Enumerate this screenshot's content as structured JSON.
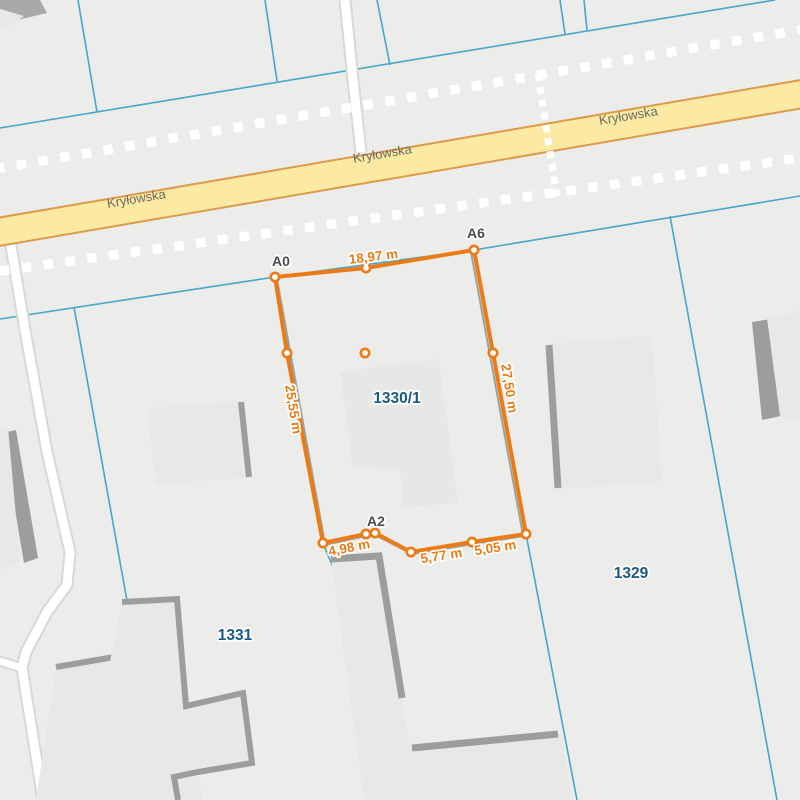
{
  "map": {
    "street_name": "Kryłowska",
    "parcel_ids": [
      "1330/1",
      "1329",
      "1331"
    ],
    "measurement_summary": {
      "vertex_names": [
        "A0",
        "A6",
        "A2"
      ],
      "segment_lengths": [
        "18,97 m",
        "27,50 m",
        "25,55 m",
        "4,98 m",
        "5,77 m",
        "5,05 m"
      ]
    },
    "colors": {
      "bg": "#ececea",
      "boundary_blue": "#46a6cb",
      "road_fill": "#fce9a2",
      "road_border": "#dd9a4b",
      "white_road": "#ffffff",
      "white_road_casing": "#d8d8d6",
      "dashed_white": "#ffffff",
      "building_fill": "#e8e8e6",
      "building_edge": "#9d9d9b",
      "building_dark": "#a9a9a7",
      "underlay_gray": "#9aa49e",
      "measure_orange": "#ec7b16",
      "measure_text": "#e87c14",
      "vertex_text": "#4b4b4b",
      "parcel_text": "#1b5a80",
      "street_text": "#6b6b66"
    },
    "layers": [
      {
        "kind": "polyline",
        "name": "parcel-boundary-upper-long",
        "stroke": "#46a6cb",
        "sw": 1.6,
        "points": [
          [
            0,
            128
          ],
          [
            775,
            0
          ]
        ]
      },
      {
        "kind": "polyline",
        "name": "parcel-boundary-top-1",
        "stroke": "#46a6cb",
        "sw": 1.6,
        "points": [
          [
            78,
            0
          ],
          [
            97,
            112
          ]
        ]
      },
      {
        "kind": "polyline",
        "name": "parcel-boundary-top-2",
        "stroke": "#46a6cb",
        "sw": 1.6,
        "points": [
          [
            265,
            0
          ],
          [
            277,
            81
          ]
        ]
      },
      {
        "kind": "polyline",
        "name": "parcel-boundary-top-3",
        "stroke": "#46a6cb",
        "sw": 1.6,
        "points": [
          [
            377,
            0
          ],
          [
            390,
            65
          ]
        ]
      },
      {
        "kind": "polyline",
        "name": "parcel-boundary-top-4",
        "stroke": "#46a6cb",
        "sw": 1.6,
        "points": [
          [
            560,
            0
          ],
          [
            565,
            34
          ]
        ]
      },
      {
        "kind": "polyline",
        "name": "parcel-boundary-top-5",
        "stroke": "#46a6cb",
        "sw": 1.6,
        "points": [
          [
            584,
            0
          ],
          [
            587,
            30
          ]
        ]
      },
      {
        "kind": "polyline",
        "name": "parcel-boundary-lower-long",
        "stroke": "#46a6cb",
        "sw": 1.6,
        "points": [
          [
            0,
            319
          ],
          [
            275,
            277
          ],
          [
            474,
            250
          ],
          [
            800,
            196
          ]
        ]
      },
      {
        "kind": "polyline",
        "name": "parcel-1331-left-boundary",
        "stroke": "#46a6cb",
        "sw": 1.6,
        "points": [
          [
            74,
            307
          ],
          [
            163,
            800
          ]
        ]
      },
      {
        "kind": "polyline",
        "name": "parcel-1330-left-boundary",
        "stroke": "#46a6cb",
        "sw": 1.6,
        "points": [
          [
            275,
            277
          ],
          [
            323,
            543
          ],
          [
            337,
            577
          ],
          [
            367,
            800
          ]
        ]
      },
      {
        "kind": "polyline",
        "name": "parcel-1330-right-boundary",
        "stroke": "#46a6cb",
        "sw": 1.6,
        "points": [
          [
            474,
            250
          ],
          [
            526,
            534
          ],
          [
            577,
            800
          ]
        ]
      },
      {
        "kind": "polyline",
        "name": "parcel-1329-right-boundary",
        "stroke": "#46a6cb",
        "sw": 1.6,
        "points": [
          [
            670,
            216
          ],
          [
            777,
            800
          ]
        ]
      },
      {
        "kind": "path",
        "name": "white-road-north-casing",
        "stroke": "#d8d8d6",
        "sw": 13,
        "d": "M345,0 L353,80 L361,152"
      },
      {
        "kind": "path",
        "name": "white-road-west-casing",
        "stroke": "#d8d8d6",
        "sw": 13,
        "d": "M10,240 L25,330 L47,452 L70,552 L67,585 L47,612 L26,652 L22,668 L43,800"
      },
      {
        "kind": "path",
        "name": "white-road-west-branch-casing",
        "stroke": "#d8d8d6",
        "sw": 11,
        "d": "M22,668 L-4,660"
      },
      {
        "kind": "path",
        "name": "white-road-north",
        "stroke": "#ffffff",
        "sw": 9,
        "d": "M345,0 L353,80 L361,152"
      },
      {
        "kind": "path",
        "name": "white-road-west",
        "stroke": "#ffffff",
        "sw": 9,
        "d": "M10,240 L25,330 L47,452 L70,552 L67,585 L47,612 L26,652 L22,668 L43,800"
      },
      {
        "kind": "path",
        "name": "white-road-west-branch",
        "stroke": "#ffffff",
        "sw": 7,
        "d": "M22,668 L-4,660"
      },
      {
        "kind": "polyline",
        "name": "road-krylowska-border",
        "stroke": "#dd9a4b",
        "sw": 30,
        "points": [
          [
            -8,
            233
          ],
          [
            808,
            93
          ]
        ]
      },
      {
        "kind": "polyline",
        "name": "road-krylowska-fill",
        "stroke": "#fce9a2",
        "sw": 26,
        "points": [
          [
            -8,
            233
          ],
          [
            808,
            93
          ]
        ]
      },
      {
        "kind": "polygon",
        "name": "building-topleft-dark",
        "fill": "#a9a9a7",
        "points": [
          [
            0,
            0
          ],
          [
            40,
            0
          ],
          [
            47,
            13
          ],
          [
            9,
            22
          ],
          [
            0,
            20
          ]
        ]
      },
      {
        "kind": "polygon",
        "name": "building-topleft-light",
        "fill": "#e8e8e6",
        "points": [
          [
            0,
            9
          ],
          [
            24,
            16
          ],
          [
            9,
            27
          ],
          [
            0,
            25
          ]
        ]
      },
      {
        "kind": "polygon",
        "name": "building-west-strip",
        "fill": "#9d9d9b",
        "points": [
          [
            2,
            433
          ],
          [
            16,
            430
          ],
          [
            38,
            558
          ],
          [
            24,
            563
          ]
        ]
      },
      {
        "kind": "polygon",
        "name": "building-west-strip-left",
        "fill": "#e8e8e6",
        "points": [
          [
            0,
            428
          ],
          [
            8,
            427
          ],
          [
            20,
            562
          ],
          [
            0,
            570
          ]
        ]
      },
      {
        "kind": "polygon",
        "name": "building-centerleft",
        "fill": "#e8e8e6",
        "points": [
          [
            147,
            408
          ],
          [
            240,
            401
          ],
          [
            250,
            477
          ],
          [
            156,
            484
          ]
        ]
      },
      {
        "kind": "polyline",
        "name": "building-centerleft-edge",
        "stroke": "#9d9d9b",
        "sw": 6,
        "points": [
          [
            241,
            402
          ],
          [
            249,
            477
          ]
        ]
      },
      {
        "kind": "polygon",
        "name": "building-parcel-1330",
        "fill": "#e7e7e5",
        "points": [
          [
            340,
            372
          ],
          [
            439,
            359
          ],
          [
            458,
            503
          ],
          [
            403,
            507
          ],
          [
            400,
            470
          ],
          [
            352,
            466
          ]
        ]
      },
      {
        "kind": "polygon",
        "name": "building-right-center",
        "fill": "#e8e8e6",
        "points": [
          [
            548,
            344
          ],
          [
            652,
            336
          ],
          [
            662,
            481
          ],
          [
            558,
            489
          ]
        ]
      },
      {
        "kind": "polyline",
        "name": "building-right-center-edge",
        "stroke": "#9d9d9b",
        "sw": 7,
        "points": [
          [
            549,
            345
          ],
          [
            558,
            488
          ]
        ]
      },
      {
        "kind": "polygon",
        "name": "building-east-dark",
        "fill": "#9d9d9b",
        "points": [
          [
            752,
            322
          ],
          [
            771,
            319
          ],
          [
            781,
            416
          ],
          [
            762,
            420
          ]
        ]
      },
      {
        "kind": "polygon",
        "name": "building-east-light",
        "fill": "#e8e8e6",
        "points": [
          [
            767,
            318
          ],
          [
            800,
            311
          ],
          [
            800,
            420
          ],
          [
            780,
            416
          ]
        ]
      },
      {
        "kind": "polygon",
        "name": "building-below-a2",
        "fill": "#e8e8e6",
        "points": [
          [
            331,
            559
          ],
          [
            379,
            556
          ],
          [
            402,
            700
          ],
          [
            410,
            745
          ],
          [
            560,
            733
          ],
          [
            572,
            800
          ],
          [
            364,
            800
          ]
        ]
      },
      {
        "kind": "polyline",
        "name": "building-below-a2-edge",
        "stroke": "#9d9d9b",
        "sw": 7,
        "points": [
          [
            331,
            559
          ],
          [
            379,
            556
          ],
          [
            402,
            698
          ]
        ]
      },
      {
        "kind": "polyline",
        "name": "building-below-a2-edge2",
        "stroke": "#9d9d9b",
        "sw": 7,
        "points": [
          [
            412,
            748
          ],
          [
            558,
            734
          ]
        ]
      },
      {
        "kind": "polygon",
        "name": "building-1331-south",
        "fill": "#e8e8e6",
        "points": [
          [
            56,
            667
          ],
          [
            132,
            654
          ],
          [
            142,
            742
          ],
          [
            96,
            800
          ],
          [
            36,
            800
          ]
        ]
      },
      {
        "kind": "polyline",
        "name": "building-1331-south-edge",
        "stroke": "#9d9d9b",
        "sw": 6,
        "points": [
          [
            56,
            667
          ],
          [
            132,
            654
          ]
        ]
      },
      {
        "kind": "polygon",
        "name": "building-1331-main",
        "fill": "#e8e8e6",
        "points": [
          [
            122,
            602
          ],
          [
            177,
            599
          ],
          [
            186,
            706
          ],
          [
            243,
            693
          ],
          [
            252,
            763
          ],
          [
            198,
            772
          ],
          [
            203,
            800
          ],
          [
            82,
            800
          ]
        ]
      },
      {
        "kind": "polyline",
        "name": "building-1331-main-edge",
        "stroke": "#9d9d9b",
        "sw": 6,
        "points": [
          [
            122,
            602
          ],
          [
            177,
            599
          ],
          [
            186,
            706
          ],
          [
            243,
            693
          ],
          [
            252,
            763
          ],
          [
            198,
            772
          ],
          [
            174,
            777
          ],
          [
            178,
            800
          ]
        ]
      },
      {
        "kind": "polyline",
        "name": "dashed-line-above-road",
        "stroke": "#ffffff",
        "sw": 9.5,
        "dash": "9.5 12.5",
        "points": [
          [
            -5,
            169
          ],
          [
            805,
            29
          ]
        ]
      },
      {
        "kind": "polyline",
        "name": "dashed-line-below-road",
        "stroke": "#ffffff",
        "sw": 9.5,
        "dash": "9.5 12.5",
        "points": [
          [
            0,
            271
          ],
          [
            800,
            158
          ]
        ]
      },
      {
        "kind": "polyline",
        "name": "dashed-line-crossing",
        "stroke": "#ffffff",
        "sw": 7,
        "dash": "7 6",
        "points": [
          [
            538,
            74
          ],
          [
            557,
            198
          ]
        ]
      },
      {
        "kind": "polyline",
        "name": "measure-underlay-right",
        "stroke": "#9aa49e",
        "sw": 2,
        "points": [
          [
            471,
            252
          ],
          [
            523,
            535
          ]
        ]
      },
      {
        "kind": "polyline",
        "name": "measure-underlay-left",
        "stroke": "#9aa49e",
        "sw": 2,
        "points": [
          [
            277,
            279
          ],
          [
            325,
            544
          ]
        ]
      },
      {
        "kind": "polyline",
        "name": "measure-underlay-bottom",
        "stroke": "#9aa49e",
        "sw": 2,
        "points": [
          [
            325,
            545
          ],
          [
            366,
            536
          ],
          [
            375,
            535
          ],
          [
            412,
            554
          ],
          [
            473,
            544
          ],
          [
            524,
            536
          ]
        ]
      },
      {
        "kind": "polygon",
        "name": "measured-parcel-outline",
        "stroke": "#ec7b16",
        "sw": 4,
        "join": "round",
        "points": [
          [
            275,
            277
          ],
          [
            366,
            268
          ],
          [
            474,
            250
          ],
          [
            493,
            353
          ],
          [
            526,
            534
          ],
          [
            472,
            542
          ],
          [
            411,
            552
          ],
          [
            375,
            533
          ],
          [
            366,
            534
          ],
          [
            323,
            543
          ],
          [
            287,
            353
          ]
        ]
      }
    ],
    "vertices": [
      [
        275,
        277
      ],
      [
        366,
        268
      ],
      [
        474,
        250
      ],
      [
        493,
        353
      ],
      [
        526,
        534
      ],
      [
        472,
        542
      ],
      [
        411,
        552
      ],
      [
        375,
        533
      ],
      [
        366,
        534
      ],
      [
        323,
        543
      ],
      [
        287,
        353
      ],
      [
        365,
        353
      ]
    ],
    "texts": [
      {
        "name": "street-label-west",
        "text": "Kryłowska",
        "x": 137,
        "y": 203,
        "size": 13,
        "bold": false,
        "color": "#6b6b66",
        "rot": -9.5,
        "halo": false
      },
      {
        "name": "street-label-center",
        "text": "Kryłowska",
        "x": 383,
        "y": 158,
        "size": 13,
        "bold": false,
        "color": "#6b6b66",
        "rot": -9.5,
        "halo": false
      },
      {
        "name": "street-label-east",
        "text": "Kryłowska",
        "x": 629,
        "y": 120,
        "size": 13,
        "bold": false,
        "color": "#6b6b66",
        "rot": -9.5,
        "halo": false
      },
      {
        "name": "vertex-label-a0",
        "text": "A0",
        "x": 281,
        "y": 266,
        "size": 14,
        "bold": true,
        "color": "#4b4b4b",
        "rot": 0,
        "halo": true
      },
      {
        "name": "vertex-label-a6",
        "text": "A6",
        "x": 476,
        "y": 238,
        "size": 14,
        "bold": true,
        "color": "#4b4b4b",
        "rot": 0,
        "halo": true
      },
      {
        "name": "vertex-label-a2",
        "text": "A2",
        "x": 376,
        "y": 526,
        "size": 14,
        "bold": true,
        "color": "#4b4b4b",
        "rot": 0,
        "halo": true
      },
      {
        "name": "measure-label-top",
        "text": "18,97 m",
        "x": 374,
        "y": 261,
        "size": 13.5,
        "bold": true,
        "color": "#e87c14",
        "rot": -7,
        "halo": true
      },
      {
        "name": "measure-label-left",
        "text": "25,55 m",
        "x": 289,
        "y": 410,
        "size": 13.5,
        "bold": true,
        "color": "#e87c14",
        "rot": 81,
        "halo": true
      },
      {
        "name": "measure-label-right",
        "text": "27,50 m",
        "x": 505,
        "y": 389,
        "size": 13.5,
        "bold": true,
        "color": "#e87c14",
        "rot": 81,
        "halo": true
      },
      {
        "name": "measure-label-bottom1",
        "text": "4,98 m",
        "x": 350,
        "y": 552,
        "size": 13.5,
        "bold": true,
        "color": "#e87c14",
        "rot": -11,
        "halo": true
      },
      {
        "name": "measure-label-bottom2",
        "text": "5,77 m",
        "x": 442,
        "y": 560,
        "size": 13.5,
        "bold": true,
        "color": "#e87c14",
        "rot": -9,
        "halo": true
      },
      {
        "name": "measure-label-bottom3",
        "text": "5,05 m",
        "x": 496,
        "y": 552,
        "size": 13.5,
        "bold": true,
        "color": "#e87c14",
        "rot": -9,
        "halo": true
      },
      {
        "name": "parcel-label-1330-1",
        "text": "1330/1",
        "x": 397,
        "y": 403,
        "size": 15.5,
        "bold": true,
        "color": "#1b5a80",
        "rot": 0,
        "halo": true
      },
      {
        "name": "parcel-label-1329",
        "text": "1329",
        "x": 631,
        "y": 578,
        "size": 15.5,
        "bold": true,
        "color": "#1b5a80",
        "rot": 0,
        "halo": true
      },
      {
        "name": "parcel-label-1331",
        "text": "1331",
        "x": 235,
        "y": 640,
        "size": 15.5,
        "bold": true,
        "color": "#1b5a80",
        "rot": 0,
        "halo": true
      }
    ]
  }
}
